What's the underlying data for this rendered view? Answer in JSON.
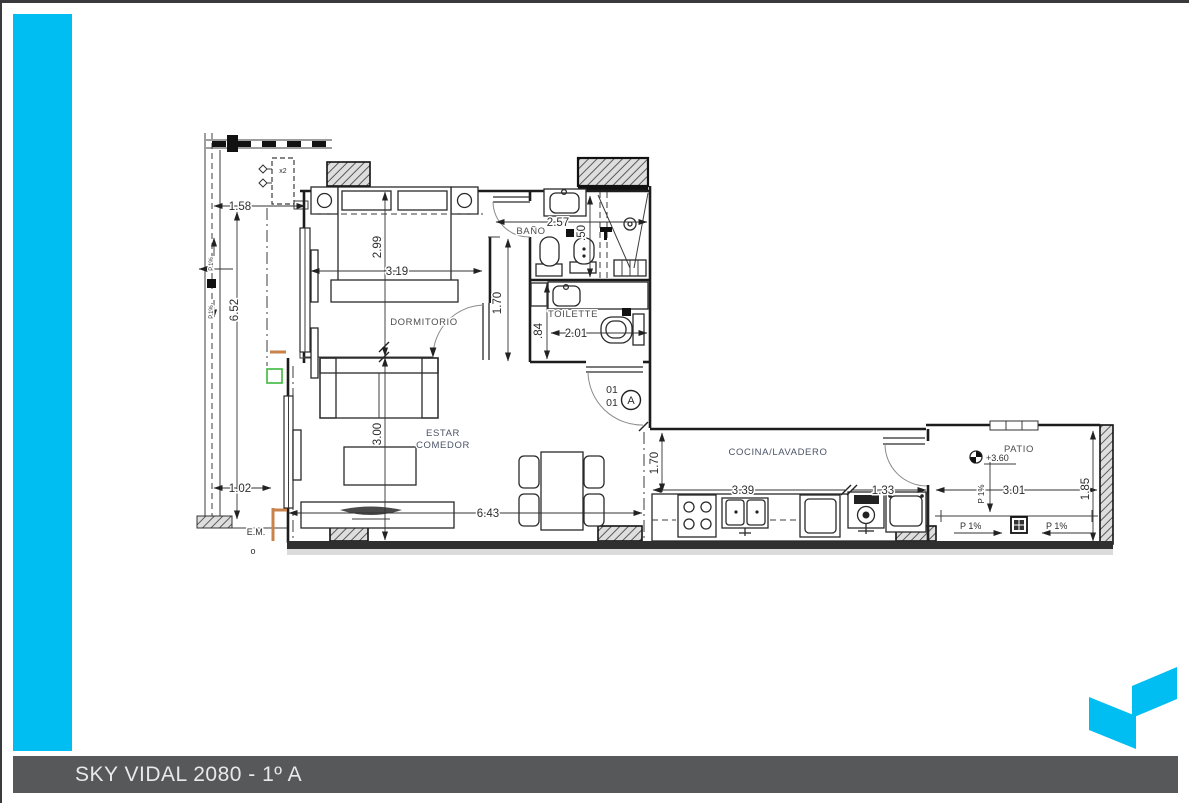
{
  "footer": {
    "title": "SKY VIDAL 2080 - 1º A"
  },
  "colors": {
    "accent": "#00bdf2",
    "footer_bg": "#57585a",
    "drawing_line": "#1c1c1c",
    "estar_label": "#4a5366",
    "em_label": "#b06a3c",
    "wall_accent_orange": "#c8824b",
    "wall_accent_green": "#3db93d"
  },
  "rooms": {
    "dormitorio": "DORMITORIO",
    "bano": "BAÑO",
    "toilette": "TOILETTE",
    "estar_line1": "ESTAR",
    "estar_line2": "COMEDOR",
    "cocina": "COCINA/LAVADERO",
    "patio": "PATIO"
  },
  "dims": {
    "balcony_width": "1.58",
    "balcony_length": "6.52",
    "balcony_end": "1.02",
    "dorm_depth": "2.99",
    "dorm_width": "3.19",
    "hall_height": "1.70",
    "bano_width": "2.57",
    "shower_width": ".50",
    "toilette_depth": ".84",
    "toilette_width": "2.01",
    "estar_depth": "3.00",
    "estar_width": "6.43",
    "cocina_depth": "1.70",
    "cocina_width": "3.39",
    "lavadero_width": "1.33",
    "patio_width": "3.01",
    "patio_depth": "1.85"
  },
  "annotations": {
    "ac_units": "x2",
    "section_num_top": "01",
    "section_num_bottom": "01",
    "section_letter": "A",
    "level": "+3.60",
    "slope_down": "P 1%",
    "slope_left": "P 1%",
    "slope_right": "P 1%",
    "em": "E.M.",
    "small_o": "o",
    "balcony_slope_1": "P.1%",
    "balcony_slope_2": "P.1%"
  }
}
